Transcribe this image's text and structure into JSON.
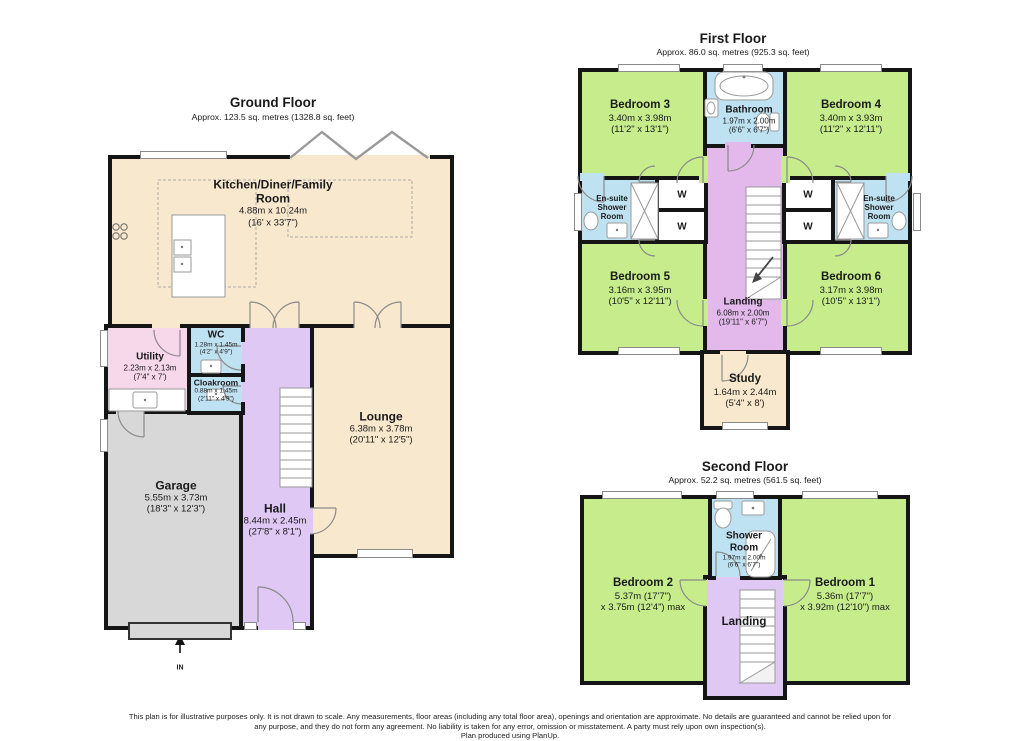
{
  "ground_floor": {
    "title": "Ground Floor",
    "subtitle": "Approx. 123.5 sq. metres (1328.8 sq. feet)",
    "entrance_label": "IN",
    "rooms": {
      "kitchen": {
        "name_line1": "Kitchen/Diner/Family",
        "name_line2": "Room",
        "dim_metric": "4.88m x 10.24m",
        "dim_imperial": "(16' x 33'7\")"
      },
      "utility": {
        "name": "Utility",
        "dim_metric": "2.23m x 2.13m",
        "dim_imperial": "(7'4\" x 7')"
      },
      "wc": {
        "name": "WC",
        "dim_metric": "1.28m x 1.45m",
        "dim_imperial": "(4'2\" x 4'9\")"
      },
      "cloakroom": {
        "name": "Cloakroom",
        "dim_metric": "0.88m x 1.45m",
        "dim_imperial": "(2'11\" x 4'9\")"
      },
      "lounge": {
        "name": "Lounge",
        "dim_metric": "6.38m x 3.78m",
        "dim_imperial": "(20'11\" x 12'5\")"
      },
      "hall": {
        "name": "Hall",
        "dim_metric": "8.44m x 2.45m",
        "dim_imperial": "(27'8\" x 8'1\")"
      },
      "garage": {
        "name": "Garage",
        "dim_metric": "5.55m x 3.73m",
        "dim_imperial": "(18'3\" x 12'3\")"
      }
    }
  },
  "first_floor": {
    "title": "First Floor",
    "subtitle": "Approx. 86.0 sq. metres (925.3 sq. feet)",
    "wardrobe_label": "W",
    "rooms": {
      "bedroom3": {
        "name": "Bedroom 3",
        "dim_metric": "3.40m x 3.98m",
        "dim_imperial": "(11'2\" x 13'1\")"
      },
      "bathroom": {
        "name": "Bathroom",
        "dim_metric": "1.97m x 2.00m",
        "dim_imperial": "(6'6\" x 6'7\")"
      },
      "bedroom4": {
        "name": "Bedroom 4",
        "dim_metric": "3.40m x 3.93m",
        "dim_imperial": "(11'2\" x 12'11\")"
      },
      "ensuite": {
        "line1": "En-suite",
        "line2": "Shower",
        "line3": "Room"
      },
      "bedroom5": {
        "name": "Bedroom 5",
        "dim_metric": "3.16m x 3.95m",
        "dim_imperial": "(10'5\" x 12'11\")"
      },
      "bedroom6": {
        "name": "Bedroom 6",
        "dim_metric": "3.17m x 3.98m",
        "dim_imperial": "(10'5\" x 13'1\")"
      },
      "landing": {
        "name": "Landing",
        "dim_metric": "6.08m x 2.00m",
        "dim_imperial": "(19'11\" x 6'7\")"
      },
      "study": {
        "name": "Study",
        "dim_metric": "1.64m x 2.44m",
        "dim_imperial": "(5'4\" x 8')"
      }
    }
  },
  "second_floor": {
    "title": "Second Floor",
    "subtitle": "Approx. 52.2 sq. metres (561.5 sq. feet)",
    "rooms": {
      "bedroom2": {
        "name": "Bedroom 2",
        "dim_line1": "5.37m (17'7\")",
        "dim_line2": "x 3.75m (12'4\") max"
      },
      "shower_room": {
        "line1": "Shower",
        "line2": "Room",
        "dim_metric": "1.97m x 2.00m",
        "dim_imperial": "(6'6\" x 6'7\")"
      },
      "bedroom1": {
        "name": "Bedroom 1",
        "dim_line1": "5.36m (17'7\")",
        "dim_line2": "x 3.92m (12'10\") max"
      },
      "landing": {
        "name": "Landing"
      }
    }
  },
  "footer": {
    "line1": "This plan is for illustrative purposes only. It is not drawn to scale. Any measurements, floor areas (including any total floor area), openings and orientation are approximate. No details are guaranteed and cannot be relied upon for",
    "line2": "any purpose, and they do not form any agreement. No liability is taken for any error, omission or misstatement. A party must rely upon own inspection(s).",
    "line3": "Plan produced using PlanUp."
  },
  "colors": {
    "wall": "#151515",
    "living_cream": "#F8E9CE",
    "bedroom_green": "#C6EC8C",
    "bathroom_blue": "#BFE2F2",
    "utility_pink": "#F7D7EA",
    "garage_gray": "#D8D8D8",
    "hall_purple": "#DFC8F4",
    "landing_purple": "#E2B9EA"
  }
}
